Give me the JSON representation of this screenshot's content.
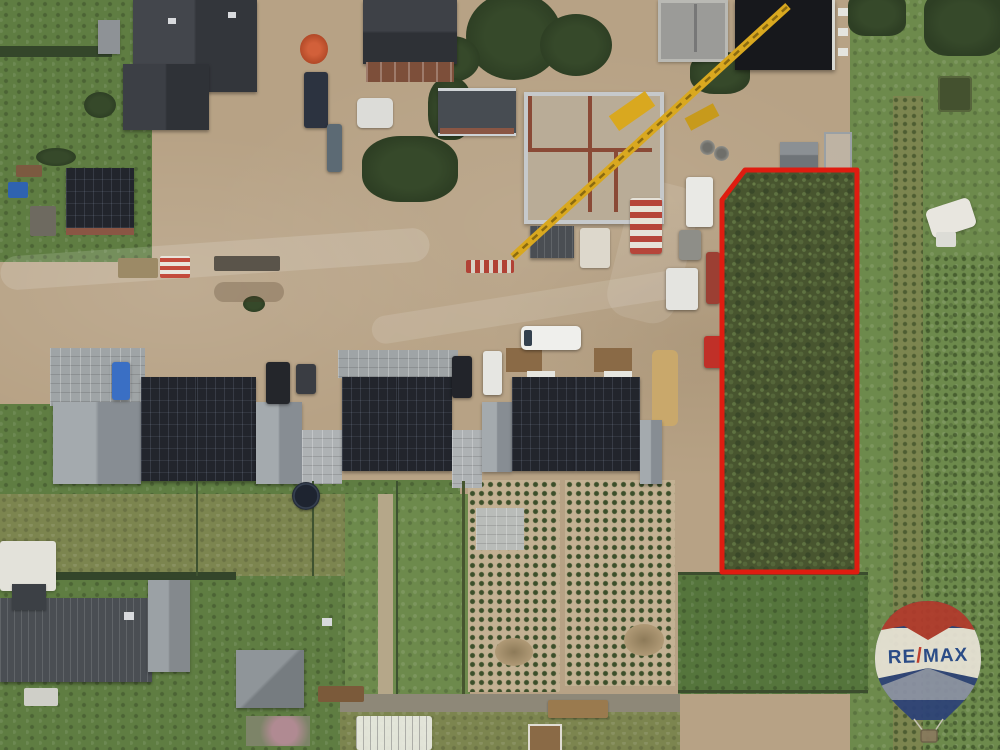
{
  "branding": {
    "balloon_text_re": "RE",
    "balloon_text_slash": "/",
    "balloon_text_max": "MAX"
  },
  "colors": {
    "plot_outline_red": "#df1c10",
    "balloon_top_red": "#b23a2c",
    "balloon_band_white": "#e9e4d7",
    "balloon_bottom_blue": "#2d4278",
    "balloon_text_blue": "#27498c",
    "balloon_slash_red": "#c53a2c",
    "solar_roof_black": "#22252c",
    "light_roof_gray": "#9aa0a5",
    "lawn_green": "#5f7d42",
    "bare_soil_tan": "#c3b193",
    "crane_yellow": "#d9a81f"
  }
}
